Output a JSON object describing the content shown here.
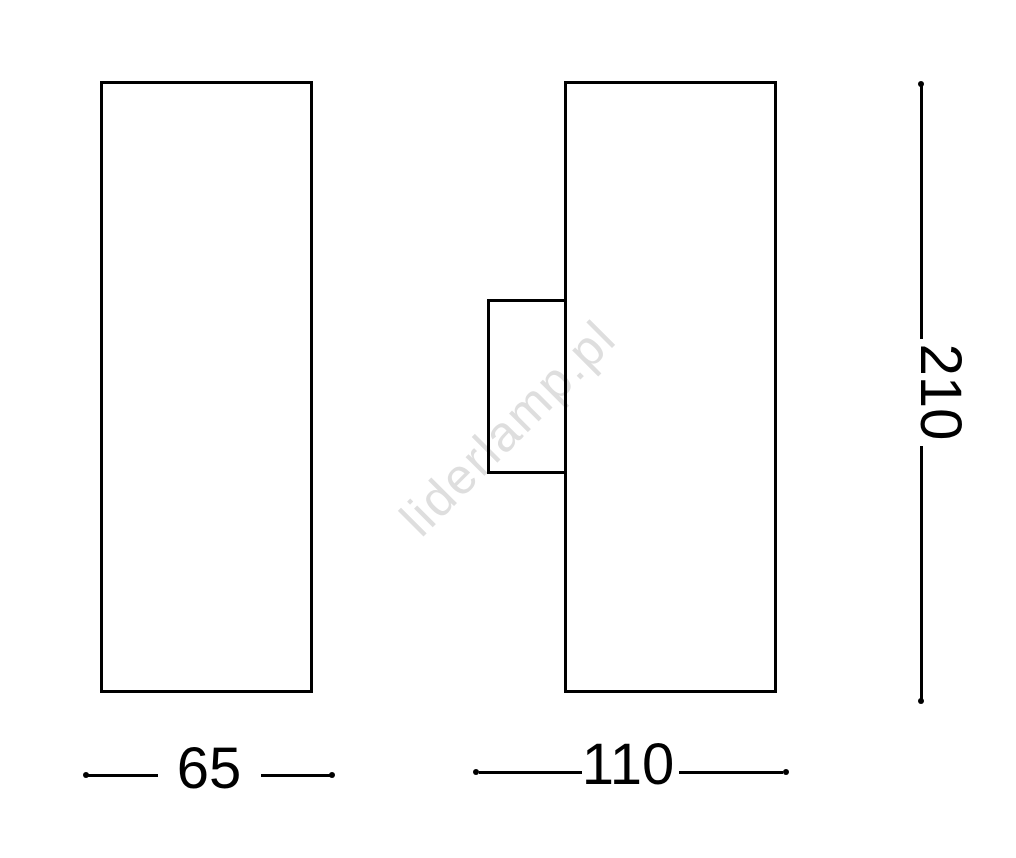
{
  "drawing": {
    "background_color": "#ffffff",
    "line_color": "#000000",
    "views": {
      "front": {
        "width_label": "65"
      },
      "side": {
        "width_label": "110"
      }
    },
    "height_label": "210",
    "watermark": {
      "text": "liderlamp.pl",
      "color": "#dedede"
    }
  }
}
